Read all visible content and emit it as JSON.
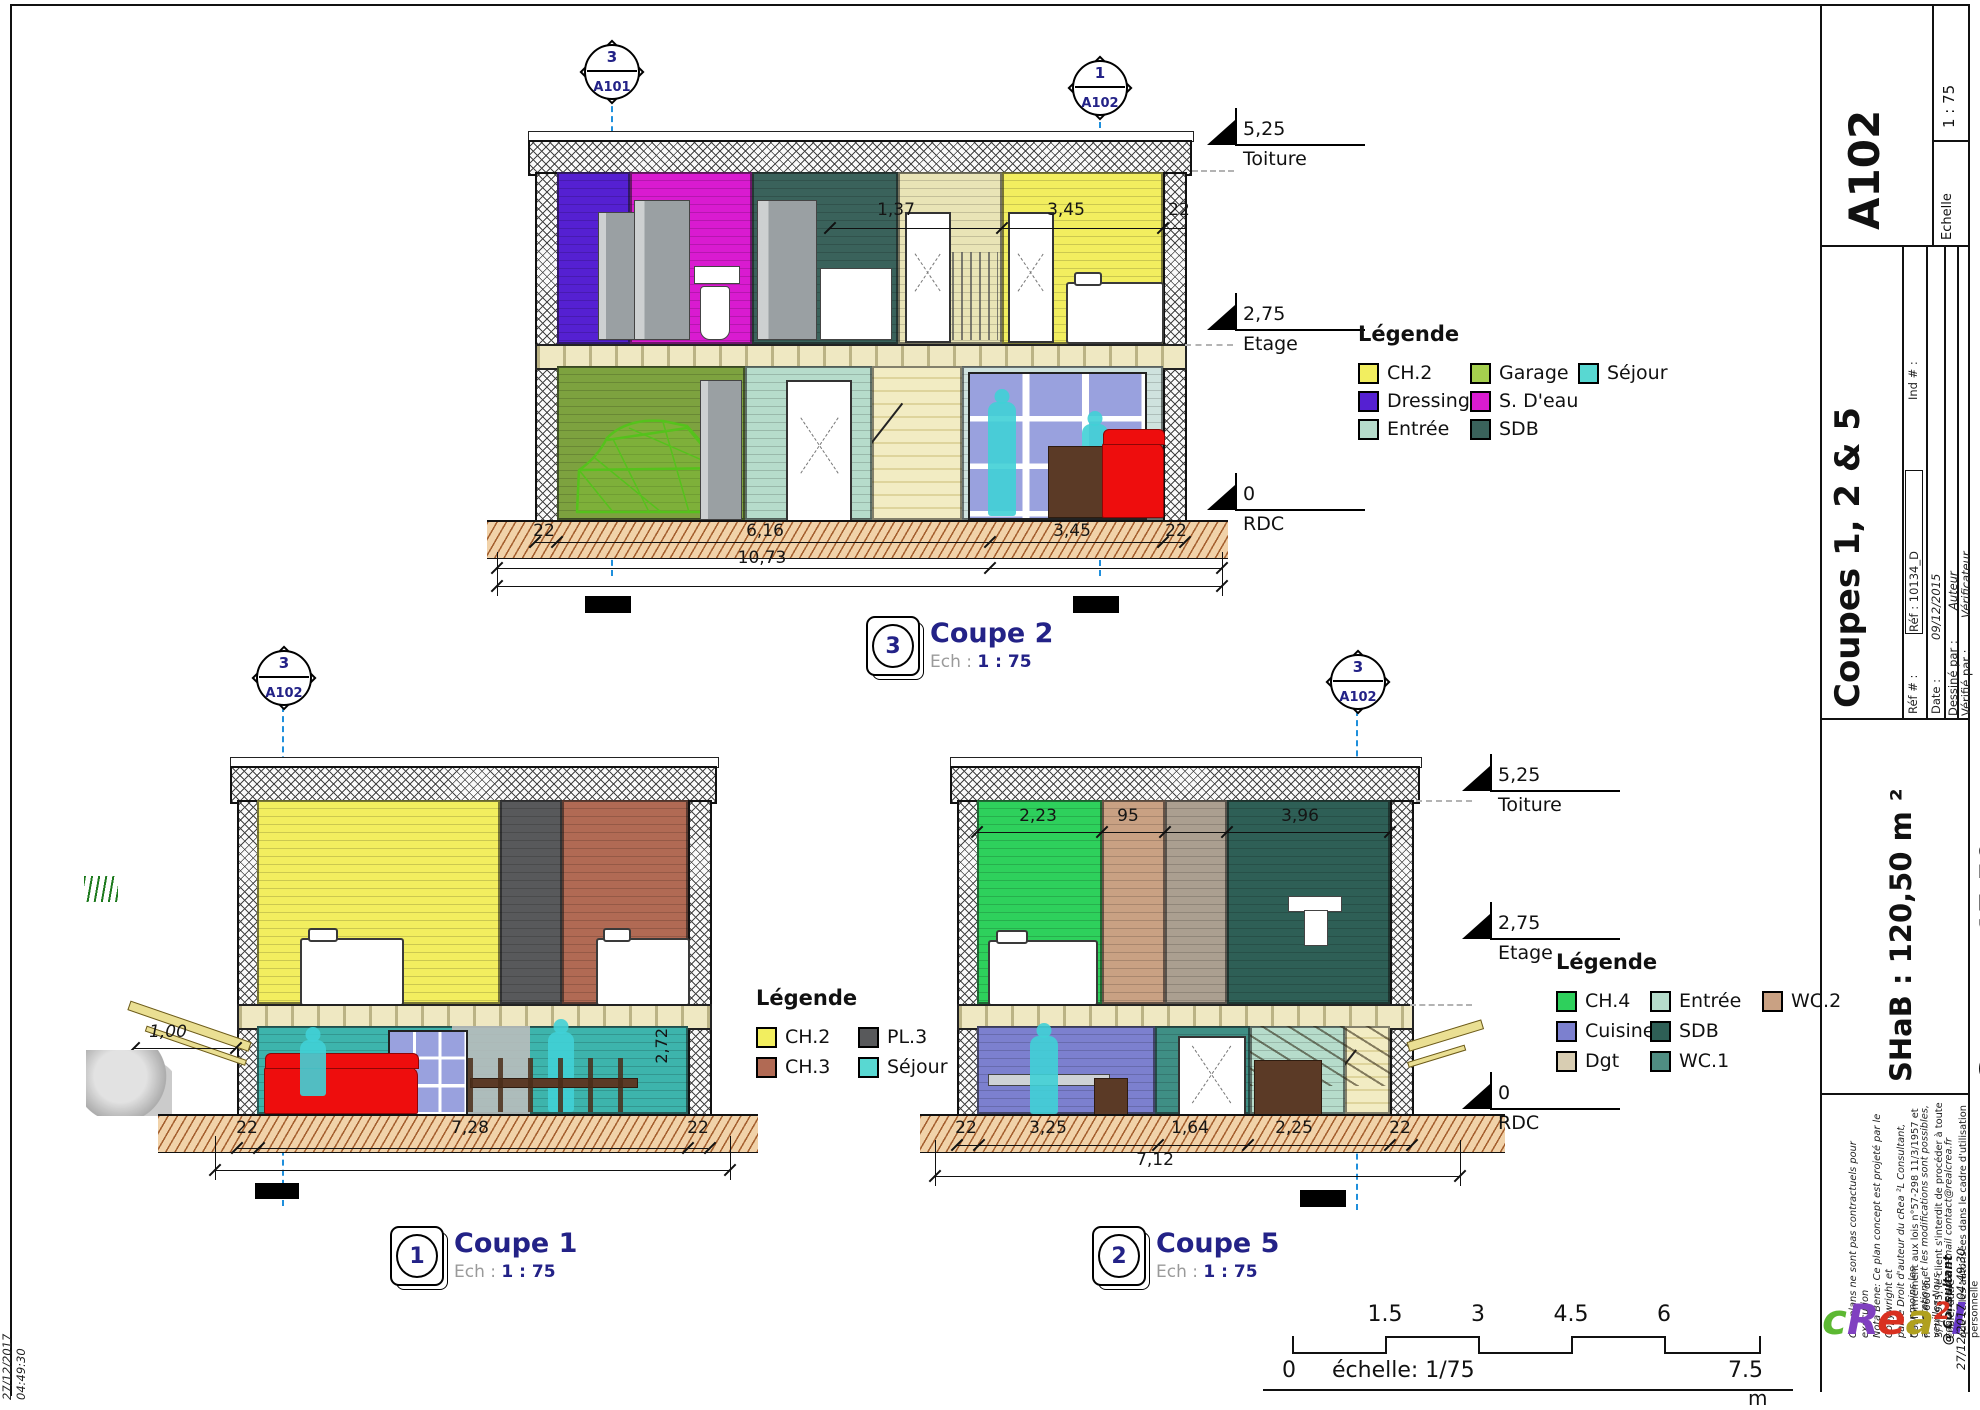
{
  "coupe2": {
    "title": "Coupe 2",
    "badge": "3",
    "scale_prefix": "Ech :",
    "scale_value": "1 : 75",
    "marker_left": {
      "num": "3",
      "sheet": "A101"
    },
    "marker_right": {
      "num": "1",
      "sheet": "A102"
    },
    "levels": [
      {
        "value": "5,25",
        "label": "Toiture"
      },
      {
        "value": "2,75",
        "label": "Etage"
      },
      {
        "value": "0",
        "label": "RDC"
      }
    ],
    "dims": {
      "top": [
        "1,37",
        "3,45",
        "22"
      ],
      "bottom": [
        "22",
        "6,16",
        "3,45",
        "22"
      ],
      "total": "10,73"
    },
    "legend": {
      "title": "Légende",
      "items": [
        {
          "label": "CH.2",
          "color": "#f2ee5f"
        },
        {
          "label": "Garage",
          "color": "#a5d04e"
        },
        {
          "label": "Séjour",
          "color": "#58d8d2"
        },
        {
          "label": "Dressing",
          "color": "#5520d2"
        },
        {
          "label": "S. D'eau",
          "color": "#d91bd0"
        },
        {
          "label": "Entrée",
          "color": "#b6dccb"
        },
        {
          "label": "SDB",
          "color": "#3a625b"
        }
      ]
    }
  },
  "coupe1": {
    "title": "Coupe 1",
    "badge": "1",
    "scale_prefix": "Ech :",
    "scale_value": "1 : 75",
    "marker_top": {
      "num": "3",
      "sheet": "A102"
    },
    "dims": {
      "porch": "1,00",
      "height": "2,72",
      "bottom": [
        "22",
        "7,28",
        "22"
      ]
    },
    "legend": {
      "title": "Légende",
      "items": [
        {
          "label": "CH.2",
          "color": "#f2ee5f"
        },
        {
          "label": "PL.3",
          "color": "#58595b"
        },
        {
          "label": "CH.3",
          "color": "#b16a54"
        },
        {
          "label": "Séjour",
          "color": "#58d8d2"
        }
      ]
    }
  },
  "coupe5": {
    "title": "Coupe 5",
    "badge": "2",
    "scale_prefix": "Ech :",
    "scale_value": "1 : 75",
    "marker_top": {
      "num": "3",
      "sheet": "A102"
    },
    "levels": [
      {
        "value": "5,25",
        "label": "Toiture"
      },
      {
        "value": "2,75",
        "label": "Etage"
      },
      {
        "value": "0",
        "label": "RDC"
      }
    ],
    "dims": {
      "top": [
        "2,23",
        "95",
        "3,96"
      ],
      "bottom": [
        "22",
        "3,25",
        "1,64",
        "2,25",
        "22"
      ],
      "total": "7,12"
    },
    "legend": {
      "title": "Légende",
      "items": [
        {
          "label": "CH.4",
          "color": "#2ed05c"
        },
        {
          "label": "Entrée",
          "color": "#b6dccb"
        },
        {
          "label": "WC.2",
          "color": "#c9a183"
        },
        {
          "label": "Cuisine",
          "color": "#7c80cf"
        },
        {
          "label": "SDB",
          "color": "#2e5f56"
        },
        {
          "label": "Dgt",
          "color": "#d8cdb2"
        },
        {
          "label": "WC.1",
          "color": "#4f8d82"
        }
      ]
    }
  },
  "scalebar": {
    "ticks": [
      "1.5",
      "3",
      "4.5",
      "6"
    ],
    "zero": "0",
    "label": "échelle: 1/75",
    "max": "7.5",
    "unit": "m"
  },
  "title_block": {
    "sheet_number": "A102",
    "scale_label": "Echelle",
    "scale_value": "1 : 75",
    "drawing_title": "Coupes 1, 2 & 5",
    "ref_label": "Réf # :",
    "ref_value": "Réf : 10134_D",
    "ind_label": "Ind # :",
    "date_label": "Date :",
    "date_value": "09/12/2015",
    "drawn_label": "Dessiné par :",
    "drawn_value": "Auteur",
    "checked_label": "Vérifié par :",
    "checked_value": "Vérificateur",
    "area_shab": "SHaB : 120,50 m ²",
    "area_garage": "Garage : 17,50 m ²",
    "ref_full": "Réf : B_10134_T",
    "legal1": "Ces plans ne sont pas contractuels pour exécution\nNota Bene: Ce plan concept est projeté par le Copywright et\npar le Droit d'auteur du cRea ²L Consultant, néanmoins les\nadaptations et les modifications sont possibles, veuillez Nous\ncontacter par e-mail contact@realcrea.fr",
    "legal2": "Conformément aux lois n°57-298 11/3/1957 et n°85-660 du\n3/7/1985, le client s'interdit de procéder à toute copie, autre\nque celles autorisées dans le cadre d'utilisation personnelle",
    "consultant": "@ Consultant",
    "timestamp": "27/12/2017 04:49:30",
    "logo": {
      "c": "c",
      "r": "R",
      "e": "e",
      "a": "a",
      "sup": "2",
      "l": "l"
    }
  }
}
